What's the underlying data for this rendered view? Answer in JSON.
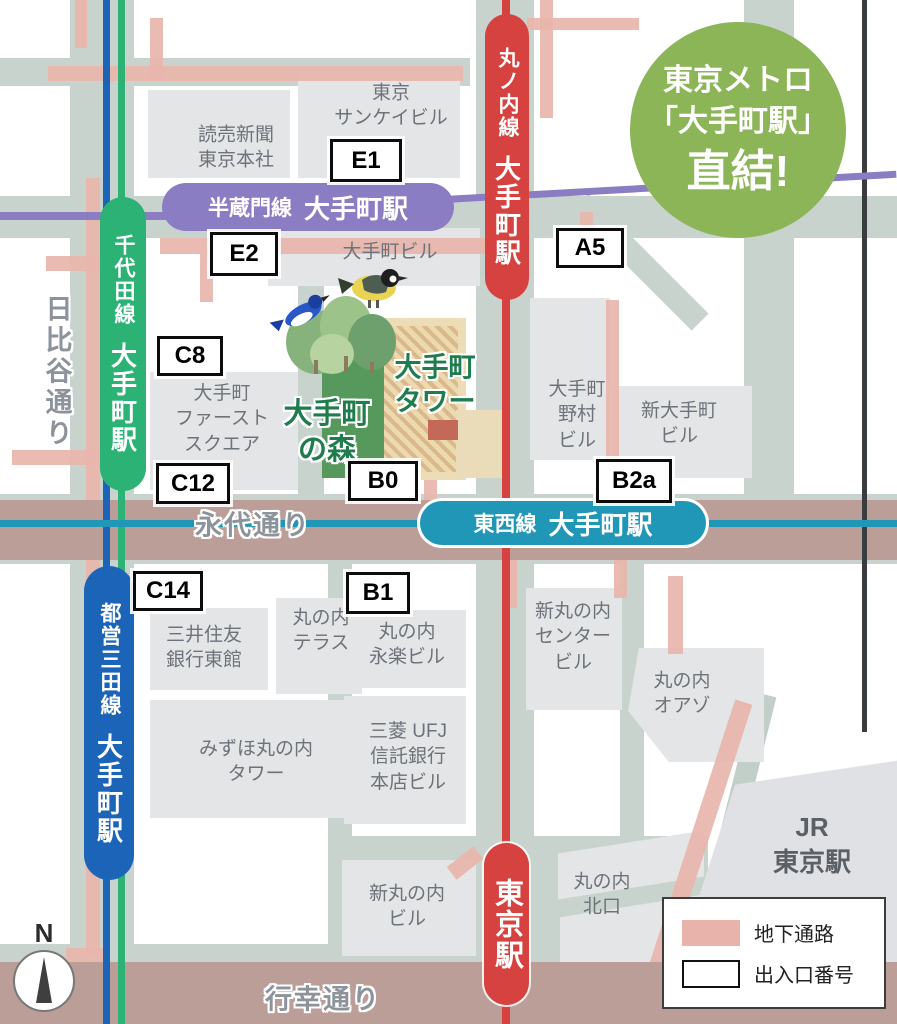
{
  "badge": {
    "l1": "東京メトロ",
    "l2": "「大手町駅」",
    "l3": "直結!"
  },
  "stations": {
    "hanzomon": {
      "line": "半蔵門線",
      "name": "大手町駅"
    },
    "chiyoda": {
      "line": "千代田線",
      "name": "大手町駅"
    },
    "marunouchi": {
      "line": "丸ノ内線",
      "name": "大手町駅"
    },
    "tozai": {
      "line": "東西線",
      "name": "大手町駅"
    },
    "mita": {
      "line": "都営三田線",
      "name": "大手町駅"
    },
    "tokyo": {
      "name": "東京駅"
    }
  },
  "exits": {
    "e1": "E1",
    "e2": "E2",
    "a5": "A5",
    "c8": "C8",
    "c12": "C12",
    "b0": "B0",
    "b2a": "B2a",
    "c14": "C14",
    "b1": "B1"
  },
  "buildings": {
    "yomiuri": {
      "l1": "読売新聞",
      "l2": "東京本社"
    },
    "sankei": {
      "l1": "東京",
      "l2": "サンケイビル"
    },
    "otemachi_bldg": {
      "l1": "大手町ビル"
    },
    "first_square": {
      "l1": "大手町",
      "l2": "ファースト",
      "l3": "スクエア"
    },
    "nomura": {
      "l1": "大手町",
      "l2": "野村",
      "l3": "ビル"
    },
    "shin_otemachi": {
      "l1": "新大手町",
      "l2": "ビル"
    },
    "smbc_east": {
      "l1": "三井住友",
      "l2": "銀行東館"
    },
    "terrace": {
      "l1": "丸の内",
      "l2": "テラス"
    },
    "eiraku": {
      "l1": "丸の内",
      "l2": "永楽ビル"
    },
    "shinmaru_center": {
      "l1": "新丸の内",
      "l2": "センター",
      "l3": "ビル"
    },
    "oazo": {
      "l1": "丸の内",
      "l2": "オアゾ"
    },
    "mizuho": {
      "l1": "みずほ丸の内",
      "l2": "タワー"
    },
    "mufg": {
      "l1": "三菱 UFJ",
      "l2": "信託銀行",
      "l3": "本店ビル"
    },
    "shinmaru_bldg": {
      "l1": "新丸の内",
      "l2": "ビル"
    },
    "kitaguchi": {
      "l1": "丸の内",
      "l2": "北口"
    },
    "jr_station": {
      "l1": "JR",
      "l2": "東京駅"
    }
  },
  "landmarks": {
    "otemachi_tower": {
      "l1": "大手町",
      "l2": "タワー"
    },
    "otemachi_forest": {
      "l1": "大手町",
      "l2": "の森"
    }
  },
  "streets": {
    "hibiya": "日比谷通り",
    "eitai": "永代通り",
    "gyoko": "行幸通り"
  },
  "legend": {
    "passage": "地下通路",
    "exit_number": "出入口番号"
  },
  "compass": {
    "n": "N"
  },
  "colors": {
    "marunouchi_red": "#d6423f",
    "chiyoda_green": "#2cb275",
    "tozai_teal": "#2097b6",
    "mita_blue": "#1c64b8",
    "hanzomon_purple": "#8b7dc3",
    "jr_dark": "#3a3d3f",
    "passage_pink": "#e8b5ab",
    "street_band": "#bb9e97",
    "badge_green": "#8cb557",
    "forest_green": "#57995c",
    "road_gray": "#c9d3ce",
    "building_gray": "#e3e5e6"
  }
}
